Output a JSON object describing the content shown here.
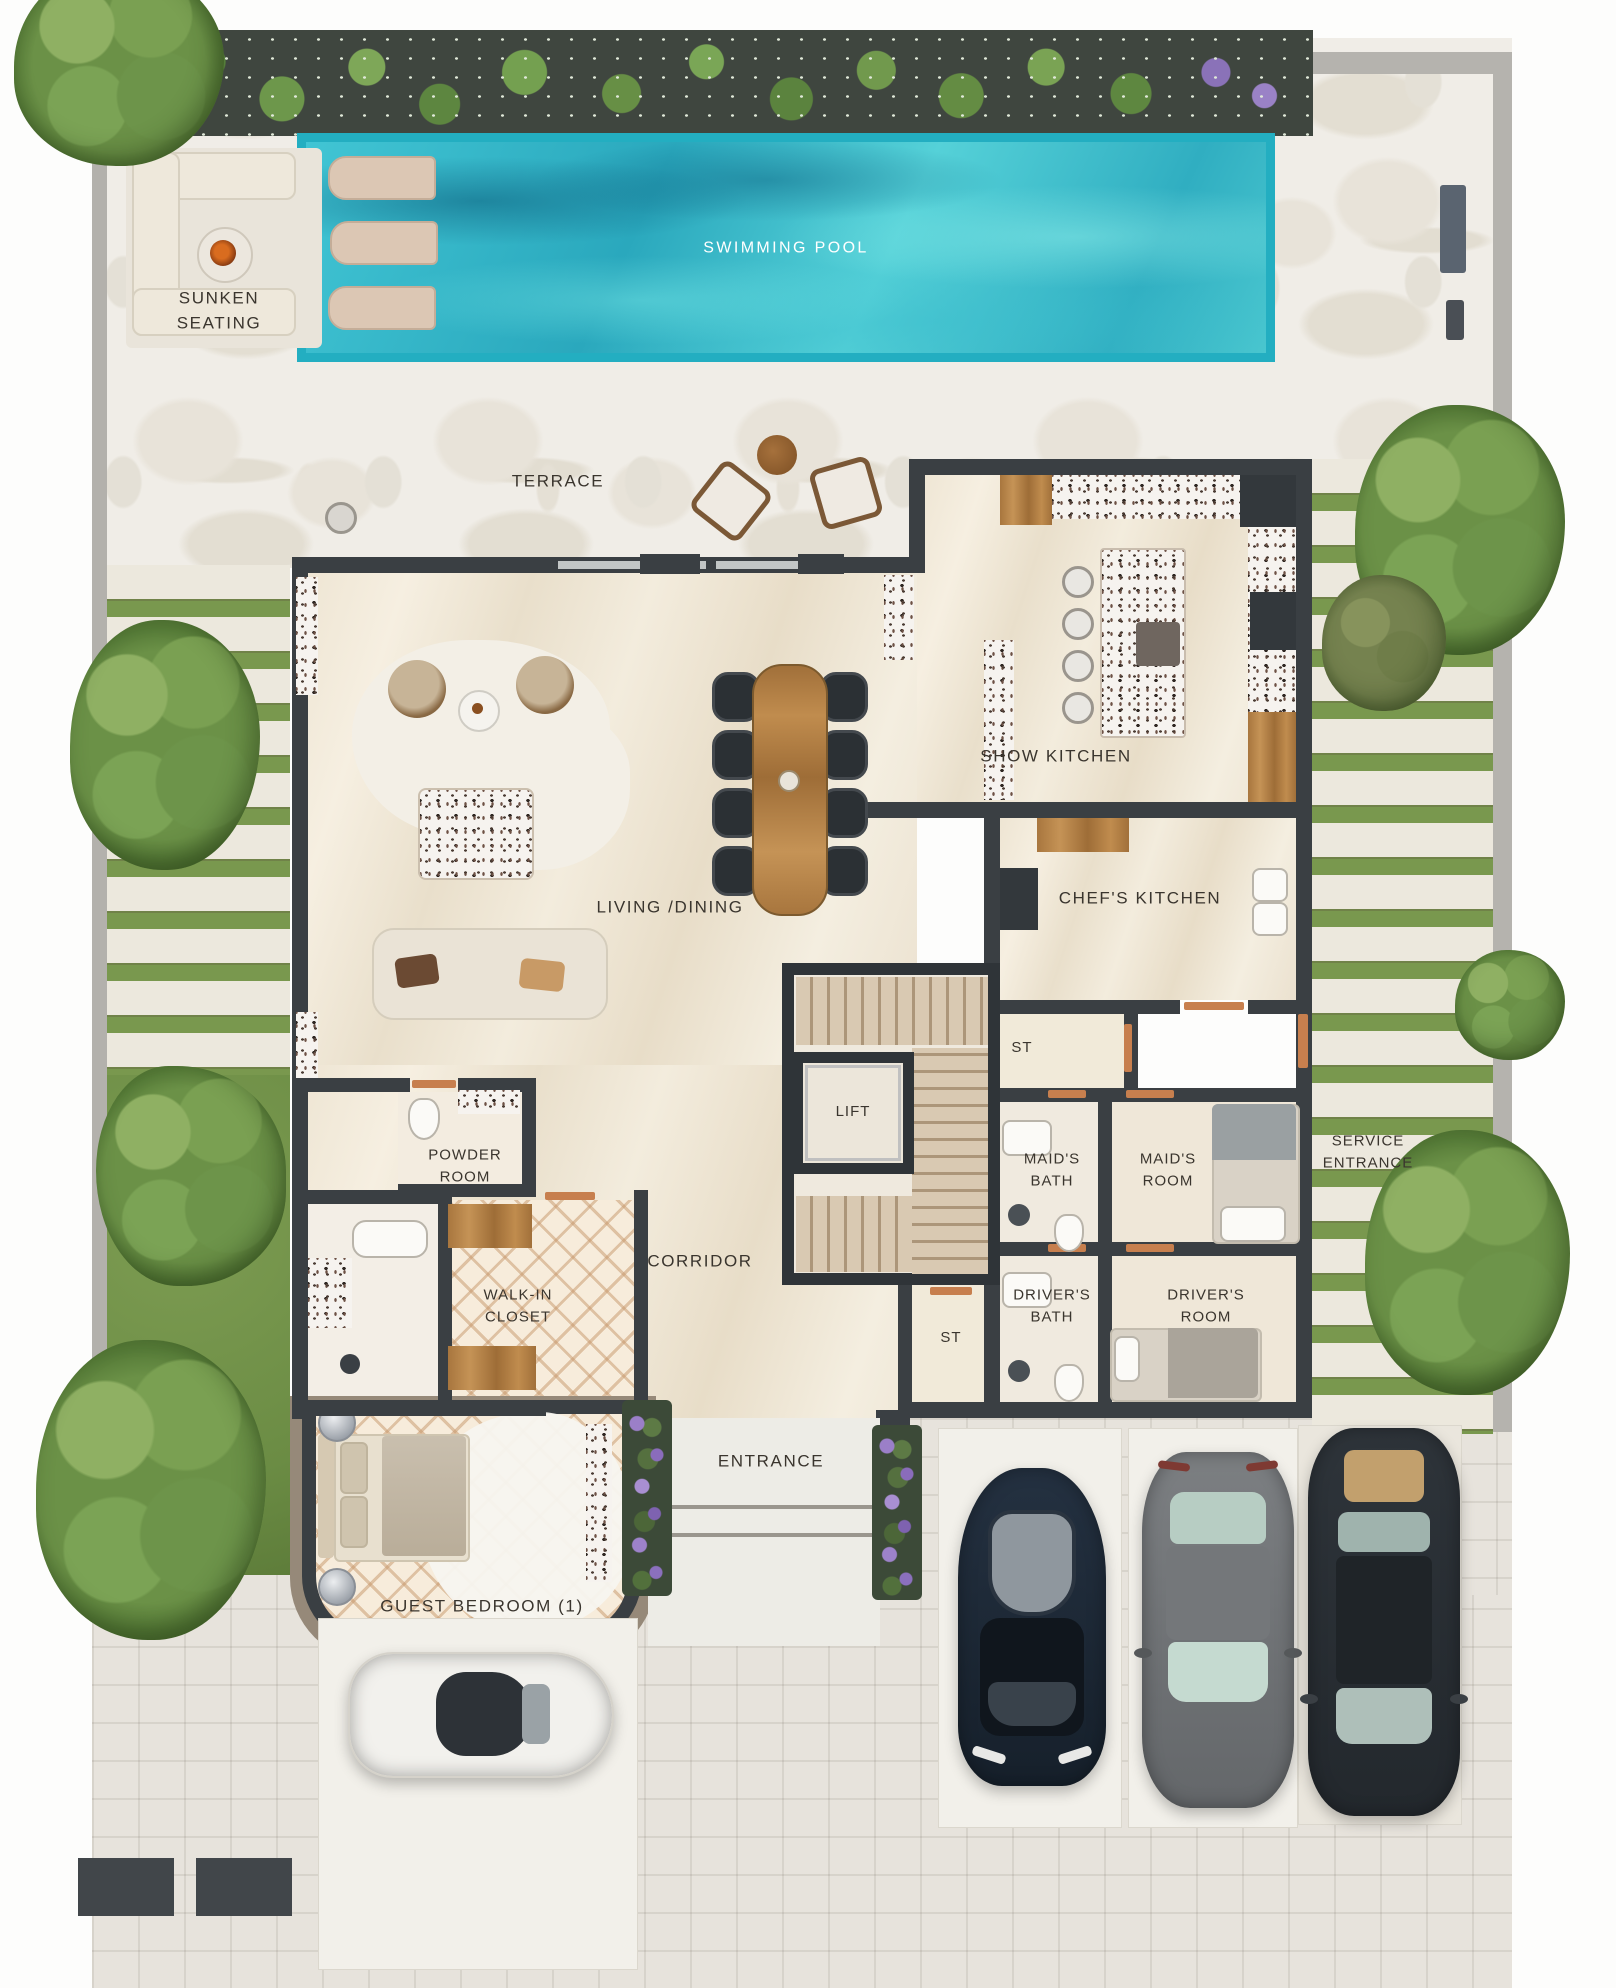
{
  "labels": {
    "swimming_pool": "SWIMMING POOL",
    "sunken_seating": "SUNKEN SEATING",
    "terrace": "TERRACE",
    "living_dining": "LIVING /DINING",
    "show_kitchen": "SHOW KITCHEN",
    "chefs_kitchen": "CHEF'S KITCHEN",
    "storage_1": "ST",
    "lift": "LIFT",
    "corridor": "CORRIDOR",
    "maids_bath": "MAID'S BATH",
    "maids_room": "MAID'S ROOM",
    "service_entrance": "SERVICE ENTRANCE",
    "storage_2": "ST",
    "drivers_bath": "DRIVER'S BATH",
    "drivers_room": "DRIVER'S ROOM",
    "powder_room": "POWDER ROOM",
    "walk_in_closet": "WALK-IN CLOSET",
    "entrance": "ENTRANCE",
    "guest_bedroom": "GUEST BEDROOM (1)"
  },
  "colors": {
    "pool_water": "#35b8c9",
    "pool_border": "#23aec1",
    "wall": "#3a3f43",
    "wood": "#b98a4e",
    "grass": "#74924b",
    "floor_marble": "#efe6d6",
    "label_text": "#3a352e",
    "label_on_water": "#ffffff"
  }
}
